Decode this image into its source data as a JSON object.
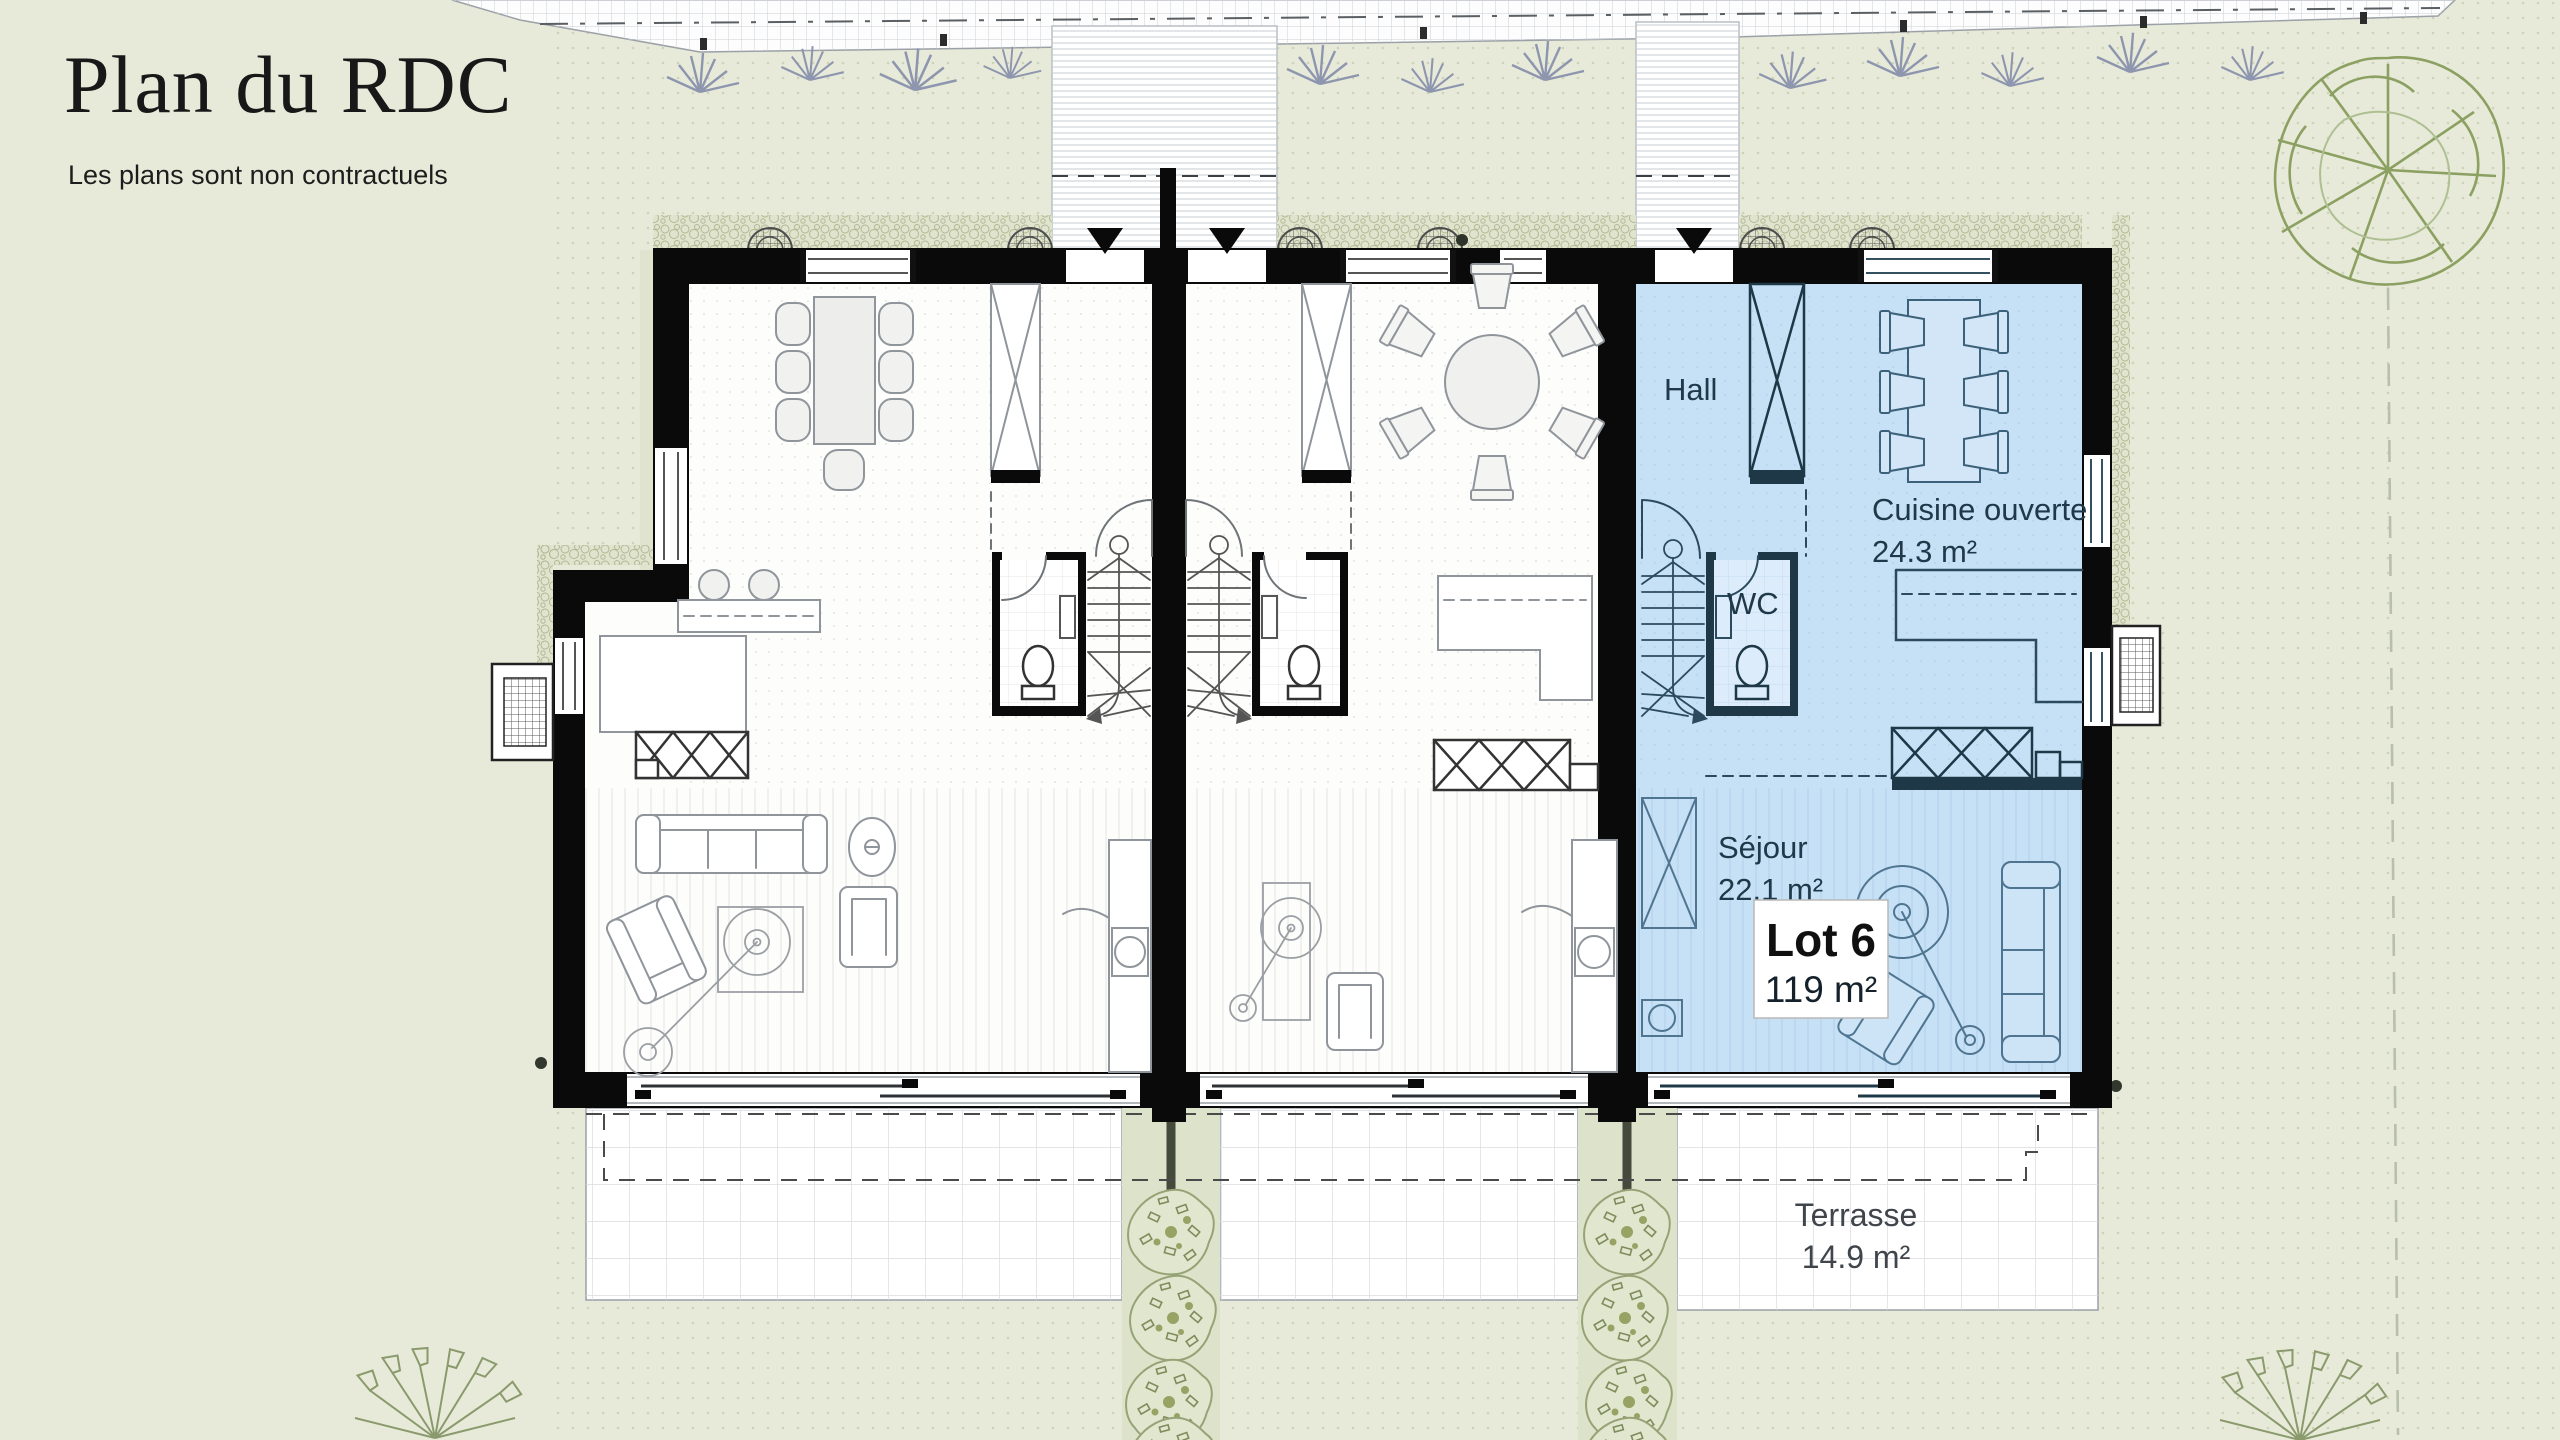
{
  "page": {
    "title": "Plan du RDC",
    "subtitle": "Les plans sont non contractuels"
  },
  "plan": {
    "lot": {
      "name": "Lot 6",
      "area": "119 m²"
    },
    "rooms": {
      "hall": {
        "label": "Hall"
      },
      "kitchen": {
        "label": "Cuisine ouverte",
        "area": "24.3 m²"
      },
      "wc": {
        "label": "WC"
      },
      "living": {
        "label": "Séjour",
        "area": "22.1 m²"
      },
      "terrace": {
        "label": "Terrasse",
        "area": "14.9 m²"
      }
    },
    "colors": {
      "background": "#e7ead9",
      "highlight_fill": "#c6e0f5",
      "highlight_line": "#1e3848",
      "wall": "#0a0a0a",
      "label_text": "#20394a",
      "vegetation": "#8ba061",
      "terrace_grid": "#d9dcdf"
    }
  }
}
